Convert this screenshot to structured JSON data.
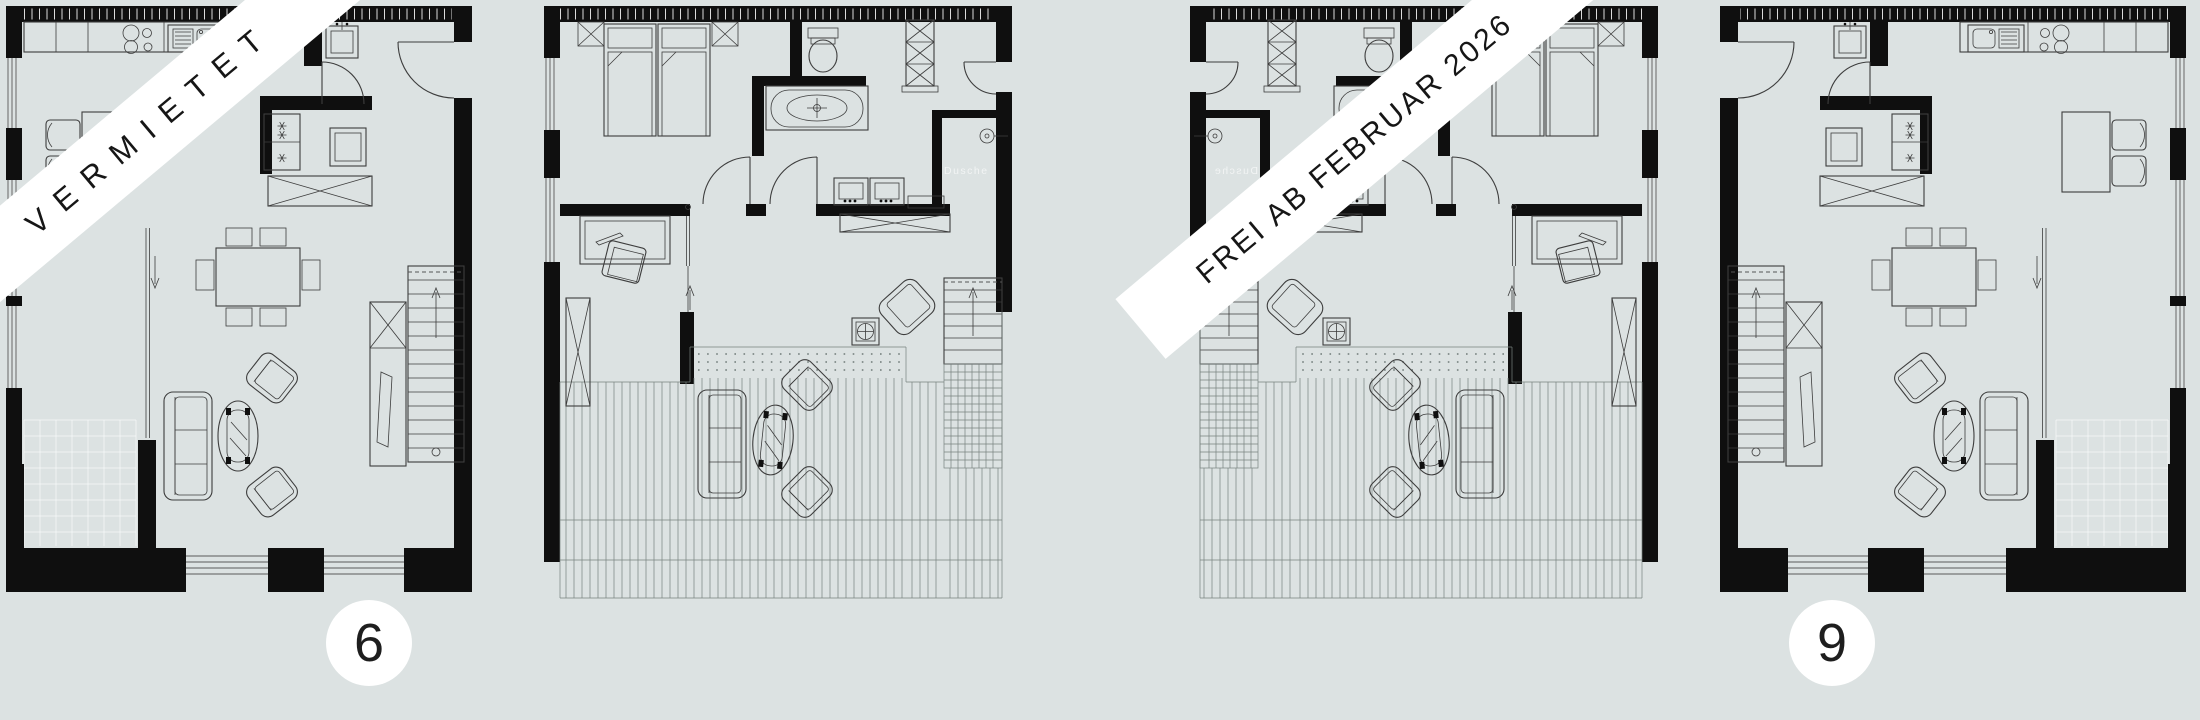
{
  "canvas": {
    "width": 2200,
    "height": 720,
    "background": "#dce2e2"
  },
  "palette": {
    "wall_ink": "#0f0f0f",
    "furniture_line": "#3d3d3d",
    "deck_line": "#77827f",
    "banner_bg": "#ffffff",
    "banner_text": "#161616",
    "badge_bg": "#ffffff",
    "badge_text": "#1e1e1e"
  },
  "banners": [
    {
      "id": "left",
      "text": "VERMIETET"
    },
    {
      "id": "right",
      "text": "FREI AB FEBRUAR 2026"
    }
  ],
  "unit_badges": [
    {
      "number": "6"
    },
    {
      "number": "9"
    }
  ],
  "labels": {
    "shower": "Dusche"
  },
  "plans": [
    {
      "name": "ground-floor-unit-6",
      "description": "ground floor plan, kitchen top, living room, stairs right"
    },
    {
      "name": "upper-floor-unit-6",
      "description": "upper floor plan with bedroom, bathroom and roof terrace"
    },
    {
      "name": "upper-floor-unit-9",
      "description": "mirrored upper floor plan with roof terrace"
    },
    {
      "name": "ground-floor-unit-9",
      "description": "mirrored ground floor plan"
    }
  ]
}
